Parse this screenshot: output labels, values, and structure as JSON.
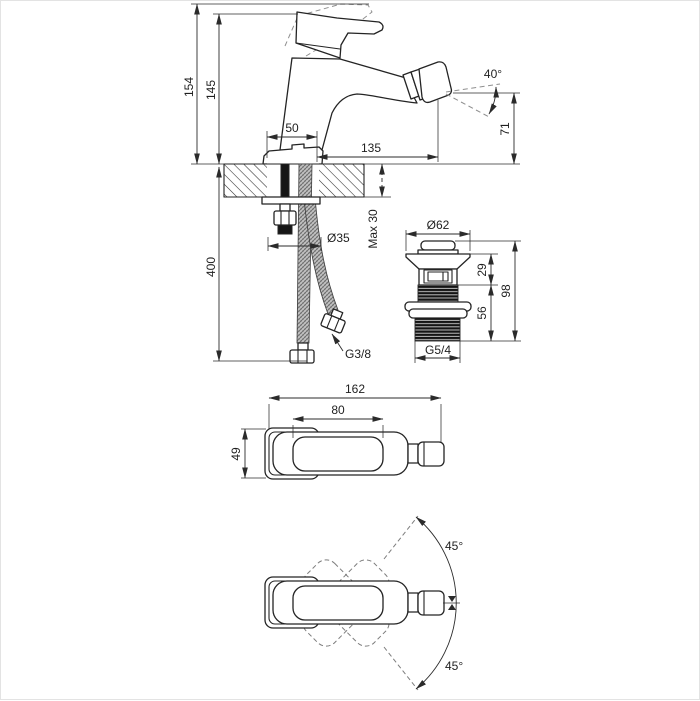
{
  "title": "Bidet mixer tap installation drawing",
  "colors": {
    "background": "#ffffff",
    "line": "#2b2b2b",
    "text": "#1f1f1f",
    "thread_fill": "#161616",
    "hose_fill": "#c9c9c9"
  },
  "dimensions": {
    "side": {
      "height_open": "154",
      "height_closed": "145",
      "base_width": "50",
      "spout_reach": "135",
      "spray_angle": "40°",
      "spout_height": "71",
      "hose_length": "400",
      "deck_thickness": "Max 30",
      "hole_diameter": "Ø35",
      "hose_thread": "G3/8"
    },
    "drain": {
      "flange_diameter": "Ø62",
      "upper_height": "29",
      "total_height": "98",
      "thread_length": "56",
      "thread_size": "G5/4"
    },
    "top": {
      "total_length": "162",
      "handle_length": "80",
      "body_width": "49"
    },
    "rotation": {
      "angle_up": "45°",
      "angle_down": "45°"
    }
  }
}
